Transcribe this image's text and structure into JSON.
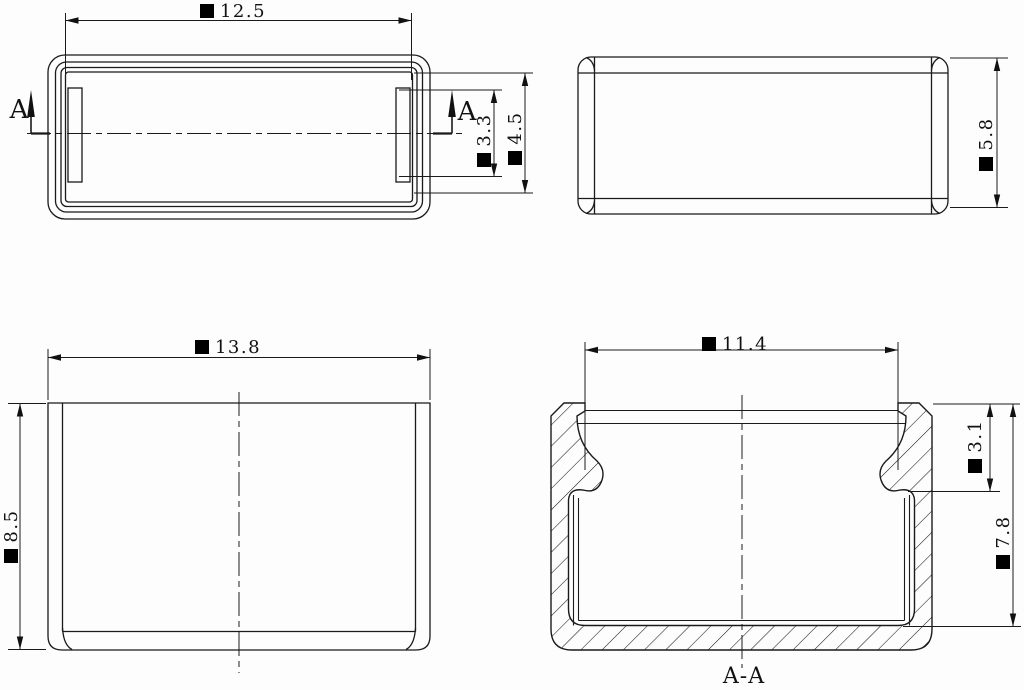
{
  "drawing": {
    "kind": "technical-drawing",
    "symbols": {
      "dimension_prefix": "■"
    },
    "views": {
      "top": {
        "section_letter_left": "A",
        "section_letter_right": "A",
        "dims": {
          "width": {
            "symbol": "■",
            "value": "12.5"
          },
          "bead_length": {
            "symbol": "■",
            "value": "3.3"
          },
          "slot_length": {
            "symbol": "■",
            "value": "4.5"
          }
        }
      },
      "side": {
        "dims": {
          "height": {
            "symbol": "■",
            "value": "5.8"
          }
        }
      },
      "front": {
        "dims": {
          "width": {
            "symbol": "■",
            "value": "13.8"
          },
          "height": {
            "symbol": "■",
            "value": "8.5"
          }
        }
      },
      "section": {
        "title": "A-A",
        "dims": {
          "inner_width": {
            "symbol": "■",
            "value": "11.4"
          },
          "lip_depth": {
            "symbol": "■",
            "value": "3.1"
          },
          "inner_height": {
            "symbol": "■",
            "value": "7.8"
          }
        }
      }
    }
  }
}
